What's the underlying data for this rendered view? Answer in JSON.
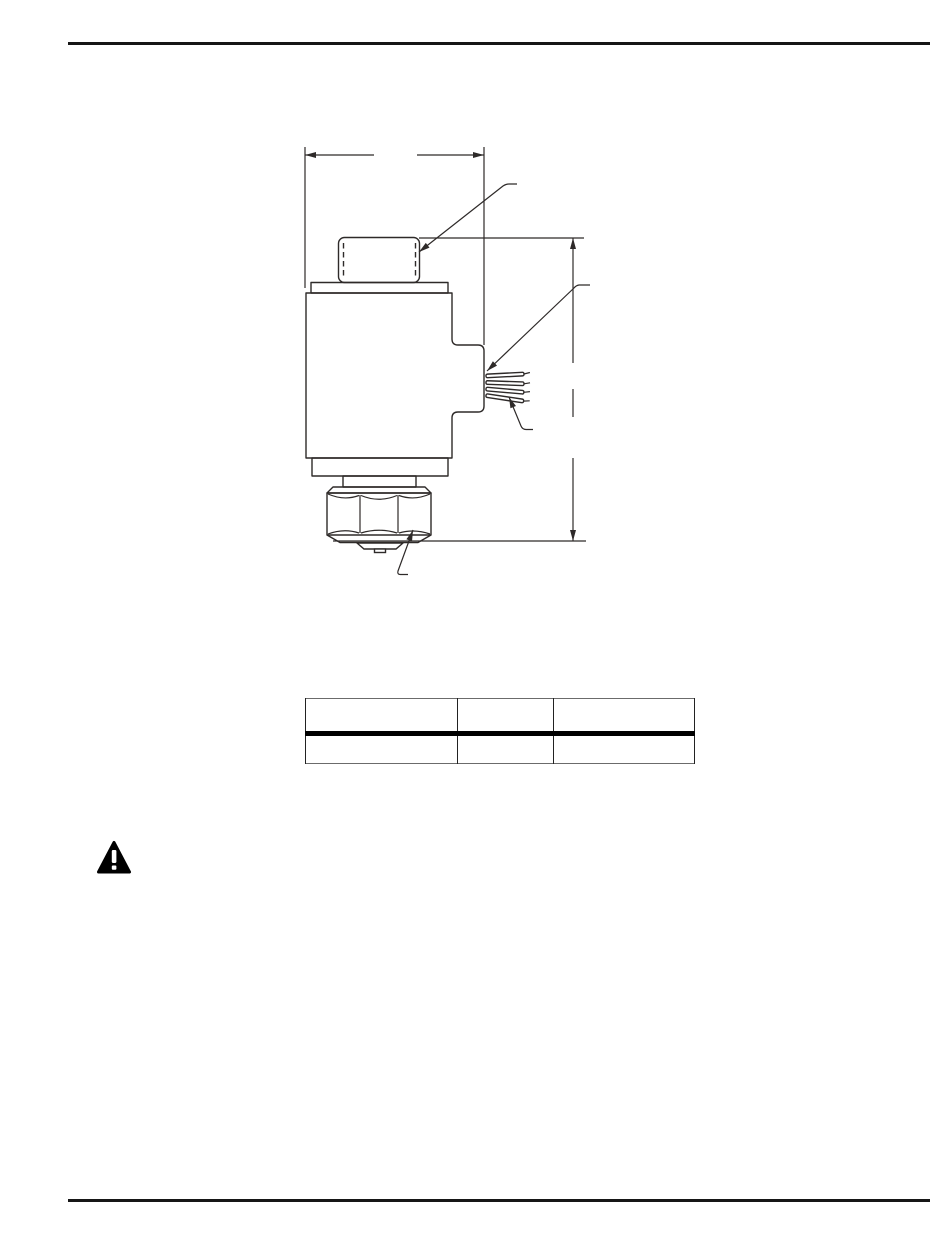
{
  "document": {
    "type": "technical-manual-page",
    "header_rule": true,
    "footer_rule": true
  },
  "colors": {
    "background": "#ffffff",
    "drawing_line": "#2e2a29",
    "page_rule": "#161616",
    "table_outer_border": "#6b6b6b",
    "table_grid": "#222222",
    "table_heavy_divider": "#000000",
    "warning_icon_fill": "#000000"
  },
  "figure": {
    "name": "solenoid-coil-dimension-drawing",
    "dimension_count": 2,
    "callout_count": 4,
    "width_dimension_label": "",
    "height_dimension_label": "",
    "callout_labels": [
      "",
      "",
      "",
      ""
    ]
  },
  "table": {
    "columns": [
      {
        "header": ""
      },
      {
        "header": ""
      },
      {
        "header": ""
      }
    ],
    "rows": [
      {
        "cells": [
          "",
          "",
          ""
        ]
      }
    ]
  },
  "warning": {
    "icon": "warning-triangle-icon",
    "text": ""
  }
}
